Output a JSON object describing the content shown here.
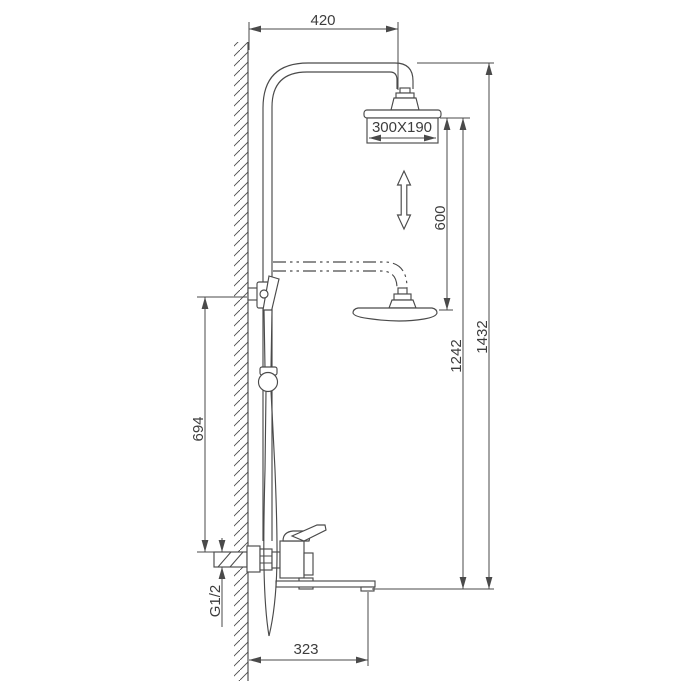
{
  "diagram": {
    "type": "technical-dimension-drawing",
    "labels": {
      "top_offset": "420",
      "overhead_size": "300X190",
      "height_adjustment": "600",
      "spout_to_head": "1242",
      "total_height": "1432",
      "wall_inlet_height": "694",
      "inlet_thread": "G1/2",
      "spout_reach": "323"
    },
    "colors": {
      "line": "#4a4a4a",
      "text": "#3d3d3d",
      "background": "#ffffff"
    }
  }
}
